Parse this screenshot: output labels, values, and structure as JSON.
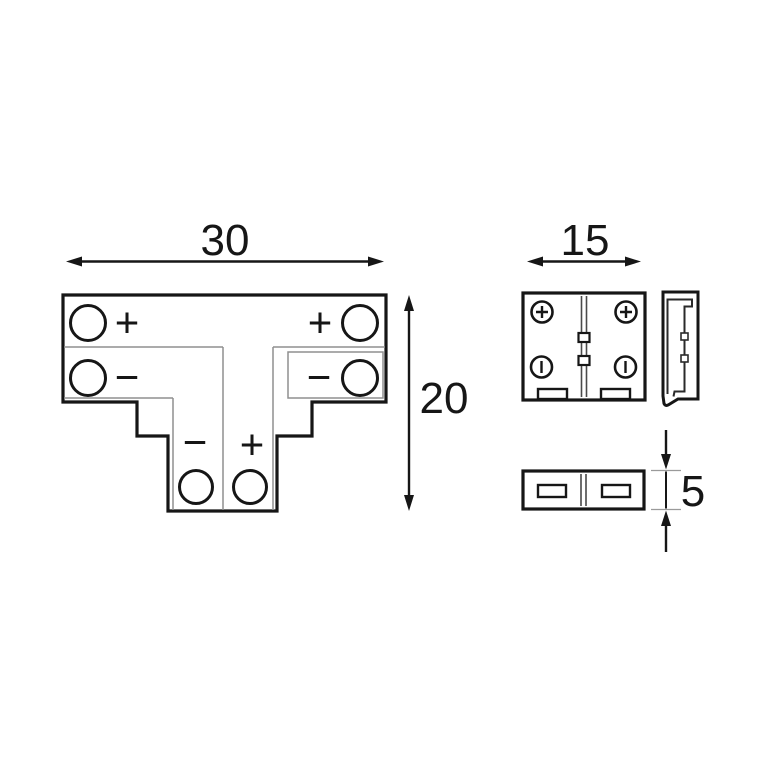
{
  "drawing": {
    "background_color": "#ffffff",
    "outline_color": "#161616",
    "thin_line_color": "#8f8f8f",
    "seam_line_color": "#4a4a4a",
    "dimensions": {
      "width": "30",
      "height": "20",
      "front_width": "15",
      "thickness": "5"
    },
    "top_view_labels": {
      "bar_top_left": "+",
      "bar_top_right": "+",
      "bar_mid_left": "−",
      "bar_mid_right": "−",
      "stem_left": "−",
      "stem_right": "+"
    },
    "front_view_icons": {
      "top_terminals": "plus-screw-icon",
      "bottom_terminals": "slot-screw-icon"
    }
  }
}
